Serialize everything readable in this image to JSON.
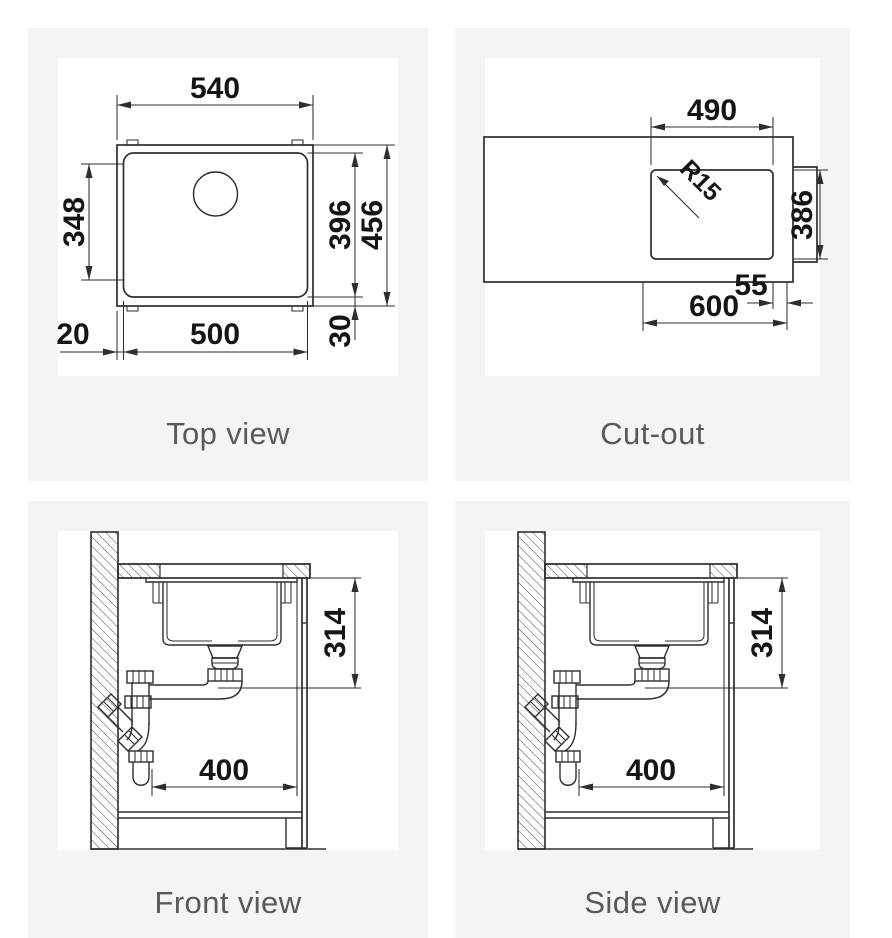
{
  "colors": {
    "page_bg": "#ffffff",
    "panel_bg": "#f4f4f5",
    "drawing_bg": "#ffffff",
    "line": "#2e2e2e",
    "dim_text": "#151515",
    "title_text": "#58595b"
  },
  "panels": {
    "top_view": {
      "title": "Top view",
      "dims": {
        "outer_width": "540",
        "inner_width": "500",
        "left_offset": "20",
        "bowl_depth_inner": "348",
        "bowl_depth": "396",
        "outer_depth": "456",
        "bottom_offset": "30"
      }
    },
    "cut_out": {
      "title": "Cut-out",
      "dims": {
        "width": "490",
        "corner_radius": "R15",
        "depth": "386",
        "side_offset": "55",
        "cabinet_width": "600"
      }
    },
    "front_view": {
      "title": "Front view",
      "dims": {
        "drain_height": "314",
        "min_cabinet_width": "400"
      }
    },
    "side_view": {
      "title": "Side view",
      "dims": {
        "drain_height": "314",
        "min_cabinet_width": "400"
      }
    }
  }
}
